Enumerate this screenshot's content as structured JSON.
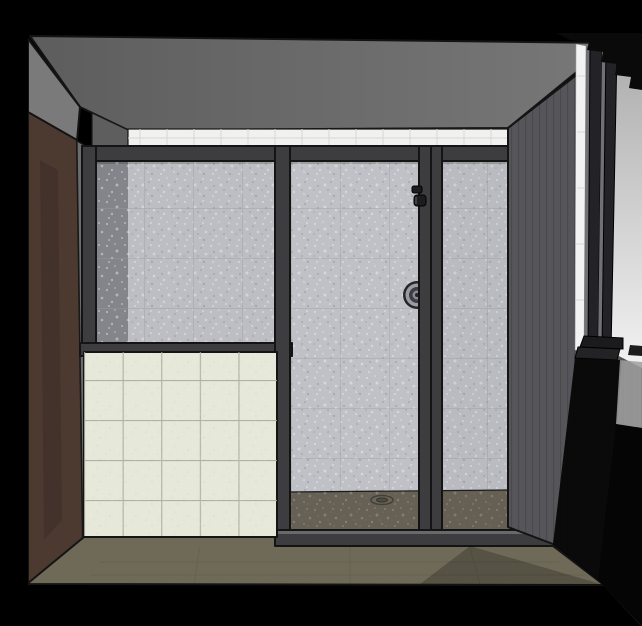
{
  "scene": {
    "title": "bathroom-shower-3d-render",
    "view": "one-point interior view of a bathroom with framed glass shower enclosure",
    "colors": {
      "background": "#000000",
      "ceiling_left": "#5d5d5d",
      "ceiling_right": "#787878",
      "west_wall_upper": "#7a7a7a",
      "west_wall_lower": "#6c6c6c",
      "brown_wall": "#4c3a31",
      "back_corner_wall": "#5e5e5e",
      "tile_strip": "#f1f1ef",
      "tile_strip_grout": "#d8d8d4",
      "marble": "#c9c9cf",
      "marble_grout": "#a4a4ac",
      "marble_shadow_band": "#8b8b92",
      "return_wall": "#83838a",
      "niche": "#46464c",
      "niche_highlight": "#ececec",
      "frame": "#3d3d3f",
      "frame_lip": "#6e6e70",
      "metal": "#1c1c1e",
      "valve_ring": "#a2a2aa",
      "cream_tile": "#e6e8da",
      "cream_grout": "#abab9e",
      "shower_floor": "#6b6557",
      "floor": "#6f6a58",
      "right_wall": "#56565a",
      "window_jamb": "#f2f2f2",
      "window_bar": "#232327",
      "window_gap": "#707075",
      "window_light_top": "#ababab",
      "window_light_bottom": "#f2f2f2",
      "sill": "#1b1b1d",
      "crown": "#0a0a0a",
      "shadow": "#050505",
      "light_patch": "#9f9f9f"
    },
    "shower": {
      "panels": 3,
      "door_position": "center",
      "fixtures": [
        "door-handle",
        "valve-control",
        "floor-drain",
        "wall-niche"
      ]
    },
    "cream_tile_grid": {
      "columns": 5,
      "rows": 5
    },
    "marble_tile_size_px": 49
  }
}
